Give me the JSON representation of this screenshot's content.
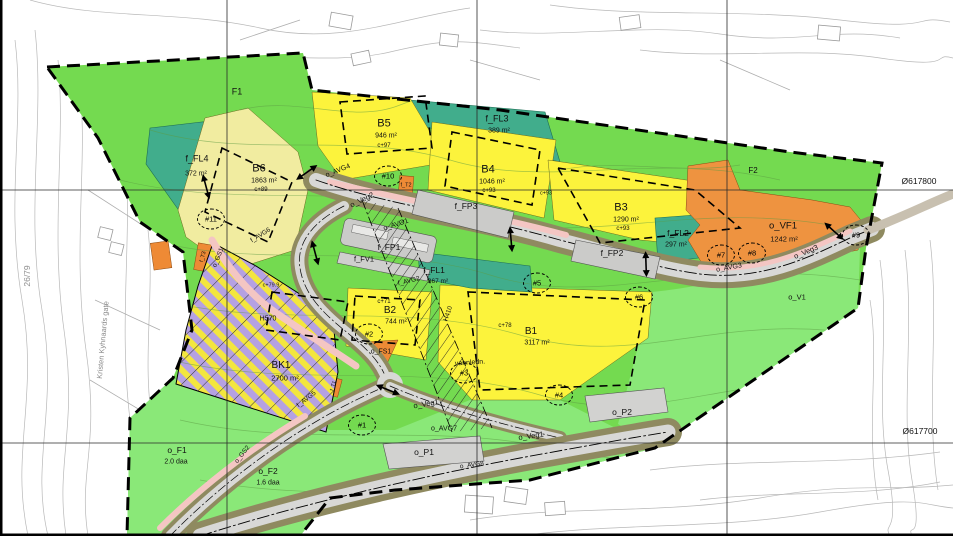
{
  "map": {
    "type": "zoning-plan-map",
    "grid": {
      "coord_label_upper": "Ø617800",
      "coord_label_lower": "Ø617700"
    },
    "colors": {
      "green_open_space": "#74da50",
      "green_light": "#8ae878",
      "teal_play_area": "#41ad8c",
      "yellow_housing": "#fcf33c",
      "yellow_pale_housing": "#f1eca0",
      "orange_service": "#ee8a35",
      "purple_hatch": "#b5a1e2",
      "road_gray": "#d8d8d6",
      "road_shoulder_olive": "#8f8a60",
      "sidewalk_pink": "#f4c6c3",
      "parking_gray": "#d2d2d0",
      "contour_gray": "#b8b8b8"
    }
  },
  "labels": [
    {
      "name": "zone-label-f1",
      "text": "F1",
      "x": 237,
      "y": 92,
      "s": 9
    },
    {
      "name": "zone-label-f2",
      "text": "F2",
      "x": 753,
      "y": 171,
      "s": 8
    },
    {
      "name": "zone-label-f-fl4",
      "text": "f_FL4",
      "x": 197,
      "y": 159,
      "s": 9
    },
    {
      "name": "zone-area-f-fl4",
      "text": "372 m²",
      "x": 196,
      "y": 174,
      "s": 7
    },
    {
      "name": "zone-label-b6",
      "text": "B6",
      "x": 259,
      "y": 169,
      "s": 11
    },
    {
      "name": "zone-area-b6",
      "text": "1863 m²",
      "x": 264,
      "y": 181,
      "s": 7
    },
    {
      "name": "zone-height-b6",
      "text": "c+89",
      "x": 261,
      "y": 190,
      "s": 6
    },
    {
      "name": "zone-label-b5",
      "text": "B5",
      "x": 384,
      "y": 124,
      "s": 11
    },
    {
      "name": "zone-area-b5",
      "text": "946 m²",
      "x": 386,
      "y": 136,
      "s": 7
    },
    {
      "name": "zone-height-b5",
      "text": "c+97",
      "x": 384,
      "y": 146,
      "s": 6
    },
    {
      "name": "zone-label-f-fl3",
      "text": "f_FL3",
      "x": 497,
      "y": 119,
      "s": 9
    },
    {
      "name": "zone-area-f-fl3",
      "text": "389 m²",
      "x": 499,
      "y": 131,
      "s": 7
    },
    {
      "name": "zone-label-b4",
      "text": "B4",
      "x": 488,
      "y": 170,
      "s": 11
    },
    {
      "name": "zone-area-b4",
      "text": "1046 m²",
      "x": 492,
      "y": 182,
      "s": 7
    },
    {
      "name": "zone-height-b4",
      "text": "c+93",
      "x": 489,
      "y": 191,
      "s": 6
    },
    {
      "name": "zone-label-b3",
      "text": "B3",
      "x": 621,
      "y": 208,
      "s": 11
    },
    {
      "name": "zone-area-b3",
      "text": "1290 m²",
      "x": 626,
      "y": 220,
      "s": 7
    },
    {
      "name": "zone-height-b3",
      "text": "c+93",
      "x": 623,
      "y": 229,
      "s": 6
    },
    {
      "name": "spot-height",
      "text": "c+93",
      "x": 546,
      "y": 194,
      "s": 5.5
    },
    {
      "name": "zone-label-f-fp3",
      "text": "f_FP3",
      "x": 466,
      "y": 206,
      "s": 8.5
    },
    {
      "name": "zone-label-f-fp2",
      "text": "f_FP2",
      "x": 612,
      "y": 253,
      "s": 8.5
    },
    {
      "name": "zone-label-f-fl2",
      "text": "f_FL2",
      "x": 678,
      "y": 233,
      "s": 8.5
    },
    {
      "name": "zone-area-f-fl2",
      "text": "297 m²",
      "x": 676,
      "y": 245,
      "s": 7
    },
    {
      "name": "zone-label-o-vf1",
      "text": "o_VF1",
      "x": 783,
      "y": 226,
      "s": 9.5
    },
    {
      "name": "zone-area-o-vf1",
      "text": "1242 m²",
      "x": 784,
      "y": 239,
      "s": 7.5
    },
    {
      "name": "grid-coord-upper",
      "text": "Ø617800",
      "x": 919,
      "y": 181,
      "s": 8.5
    },
    {
      "name": "grid-coord-lower",
      "text": "Ø617700",
      "x": 920,
      "y": 431,
      "s": 8.5
    },
    {
      "name": "road-label-o-veg3",
      "text": "o_Veg3",
      "x": 806,
      "y": 252,
      "s": 7.5,
      "rot": -23
    },
    {
      "name": "zone-label-o-v1",
      "text": "o_V1",
      "x": 797,
      "y": 297,
      "s": 7.5
    },
    {
      "name": "road-label-o-avg3",
      "text": "o_AVG3",
      "x": 729,
      "y": 268,
      "s": 7,
      "rot": -10
    },
    {
      "name": "road-label-o-veg2",
      "text": "o_Veg2",
      "x": 362,
      "y": 200,
      "s": 7.5,
      "rot": -26
    },
    {
      "name": "road-label-o-avg4",
      "text": "o_AVG4",
      "x": 338,
      "y": 171,
      "s": 7,
      "rot": -22
    },
    {
      "name": "road-label-o-avg1",
      "text": "o_AVG1",
      "x": 396,
      "y": 225,
      "s": 7,
      "rot": -18
    },
    {
      "name": "zone-label-f-fp1",
      "text": "f_FP1",
      "x": 389,
      "y": 247,
      "s": 8.5
    },
    {
      "name": "zone-label-f-fv1",
      "text": "f_FV1",
      "x": 364,
      "y": 259,
      "s": 7.5
    },
    {
      "name": "road-label-f-avg2",
      "text": "f_AVG2",
      "x": 409,
      "y": 282,
      "s": 6.5,
      "rot": -14
    },
    {
      "name": "zone-label-f-fl1",
      "text": "f_FL1",
      "x": 434,
      "y": 270,
      "s": 8.5
    },
    {
      "name": "zone-area-f-fl1",
      "text": "367 m²",
      "x": 438,
      "y": 282,
      "s": 6.5
    },
    {
      "name": "zone-label-b2",
      "text": "B2",
      "x": 390,
      "y": 311,
      "s": 10
    },
    {
      "name": "zone-area-b2",
      "text": "744 m²",
      "x": 396,
      "y": 322,
      "s": 7
    },
    {
      "name": "zone-height-b2",
      "text": "c+71",
      "x": 384,
      "y": 302,
      "s": 6
    },
    {
      "name": "zone-label-b1",
      "text": "B1",
      "x": 531,
      "y": 332,
      "s": 10
    },
    {
      "name": "zone-area-b1",
      "text": "3117 m²",
      "x": 537,
      "y": 343,
      "s": 7
    },
    {
      "name": "zone-height-b1",
      "text": "c+78",
      "x": 505,
      "y": 326,
      "s": 6
    },
    {
      "name": "zone-label-bk1",
      "text": "BK1",
      "x": 281,
      "y": 366,
      "s": 10
    },
    {
      "name": "zone-area-bk1",
      "text": "2700 m²",
      "x": 285,
      "y": 378,
      "s": 7.5
    },
    {
      "name": "hazard-label-h570",
      "text": "H570",
      "x": 268,
      "y": 319,
      "s": 7
    },
    {
      "name": "spot-height-bk1",
      "text": "c+79.9",
      "x": 271,
      "y": 286,
      "s": 5.5
    },
    {
      "name": "hazard-label-h410",
      "text": "H410",
      "x": 449,
      "y": 314,
      "s": 6.5,
      "rot": -72
    },
    {
      "name": "note-water-main",
      "text": "vannledn.",
      "x": 470,
      "y": 363,
      "s": 7,
      "rot": -4
    },
    {
      "name": "zone-label-o-fs1",
      "text": "o_FS1",
      "x": 381,
      "y": 352,
      "s": 7
    },
    {
      "name": "road-label-o-veg1-a",
      "text": "o_Veg1",
      "x": 426,
      "y": 404,
      "s": 7.5,
      "rot": -10
    },
    {
      "name": "road-label-o-veg1-b",
      "text": "o_Veg1",
      "x": 531,
      "y": 436,
      "s": 7.5,
      "rot": -8
    },
    {
      "name": "road-label-o-avg7",
      "text": "o_AVG7",
      "x": 444,
      "y": 429,
      "s": 7
    },
    {
      "name": "road-label-o-avg8",
      "text": "o_AVG8",
      "x": 472,
      "y": 466,
      "s": 6.5,
      "rot": -8
    },
    {
      "name": "zone-label-o-p1",
      "text": "o_P1",
      "x": 424,
      "y": 452,
      "s": 8.5
    },
    {
      "name": "zone-label-o-p2",
      "text": "o_P2",
      "x": 622,
      "y": 412,
      "s": 8.5
    },
    {
      "name": "road-label-f-avg5",
      "text": "f_AVG5",
      "x": 307,
      "y": 400,
      "s": 6.5,
      "rot": -38
    },
    {
      "name": "road-label-o-gs2",
      "text": "o_GS2",
      "x": 243,
      "y": 455,
      "s": 6.5,
      "rot": -52
    },
    {
      "name": "road-label-o-gs1",
      "text": "o_GS1",
      "x": 219,
      "y": 258,
      "s": 6.5,
      "rot": -68
    },
    {
      "name": "road-label-f-avg6",
      "text": "f_AVG6",
      "x": 261,
      "y": 236,
      "s": 6.5,
      "rot": -32
    },
    {
      "name": "zone-label-f-t2",
      "text": "f_T2",
      "x": 406,
      "y": 186,
      "s": 5.5
    },
    {
      "name": "zone-label-f-t3",
      "text": "f_T3",
      "x": 204,
      "y": 257,
      "s": 5.5,
      "rot": -75
    },
    {
      "name": "zone-label-f-t1",
      "text": "f_T1",
      "x": 334,
      "y": 386,
      "s": 5,
      "rot": -75
    },
    {
      "name": "zone-label-o-f1",
      "text": "o_F1",
      "x": 177,
      "y": 450,
      "s": 8.5
    },
    {
      "name": "zone-area-o-f1",
      "text": "2.0 daa",
      "x": 176,
      "y": 462,
      "s": 7
    },
    {
      "name": "zone-label-o-f2",
      "text": "o_F2",
      "x": 268,
      "y": 471,
      "s": 8.5
    },
    {
      "name": "zone-area-o-f2",
      "text": "1.6 daa",
      "x": 268,
      "y": 483,
      "s": 7
    },
    {
      "name": "cadastral-number",
      "text": "26/79",
      "x": 27,
      "y": 276,
      "s": 8.5,
      "rot": -90,
      "color": "#8f8f8f"
    },
    {
      "name": "street-name",
      "text": "Kristen Kyhnaards gate",
      "x": 103,
      "y": 340,
      "s": 7.5,
      "rot": -85,
      "color": "#8a8a8a"
    }
  ],
  "circles": [
    {
      "name": "marker-1",
      "text": "#1",
      "x": 362,
      "y": 425
    },
    {
      "name": "marker-2",
      "text": "#2",
      "x": 369,
      "y": 334
    },
    {
      "name": "marker-3",
      "text": "#3",
      "x": 464,
      "y": 373
    },
    {
      "name": "marker-4",
      "text": "#4",
      "x": 559,
      "y": 395
    },
    {
      "name": "marker-5",
      "text": "#5",
      "x": 537,
      "y": 283
    },
    {
      "name": "marker-6",
      "text": "#6",
      "x": 639,
      "y": 297
    },
    {
      "name": "marker-7",
      "text": "#7",
      "x": 721,
      "y": 255
    },
    {
      "name": "marker-8",
      "text": "#8",
      "x": 752,
      "y": 253
    },
    {
      "name": "marker-9",
      "text": "#9",
      "x": 856,
      "y": 235
    },
    {
      "name": "marker-10",
      "text": "#10",
      "x": 388,
      "y": 176
    },
    {
      "name": "marker-11",
      "text": "#11",
      "x": 211,
      "y": 219
    }
  ],
  "arrows": [
    {
      "x": 305,
      "y": 170,
      "rot": -35
    },
    {
      "x": 209,
      "y": 186,
      "rot": 75
    },
    {
      "x": 514,
      "y": 239,
      "rot": 85
    },
    {
      "x": 649,
      "y": 264,
      "rot": 88
    },
    {
      "x": 836,
      "y": 229,
      "rot": 42
    },
    {
      "x": 389,
      "y": 387,
      "rot": 22
    },
    {
      "x": 318,
      "y": 252,
      "rot": 75
    }
  ]
}
